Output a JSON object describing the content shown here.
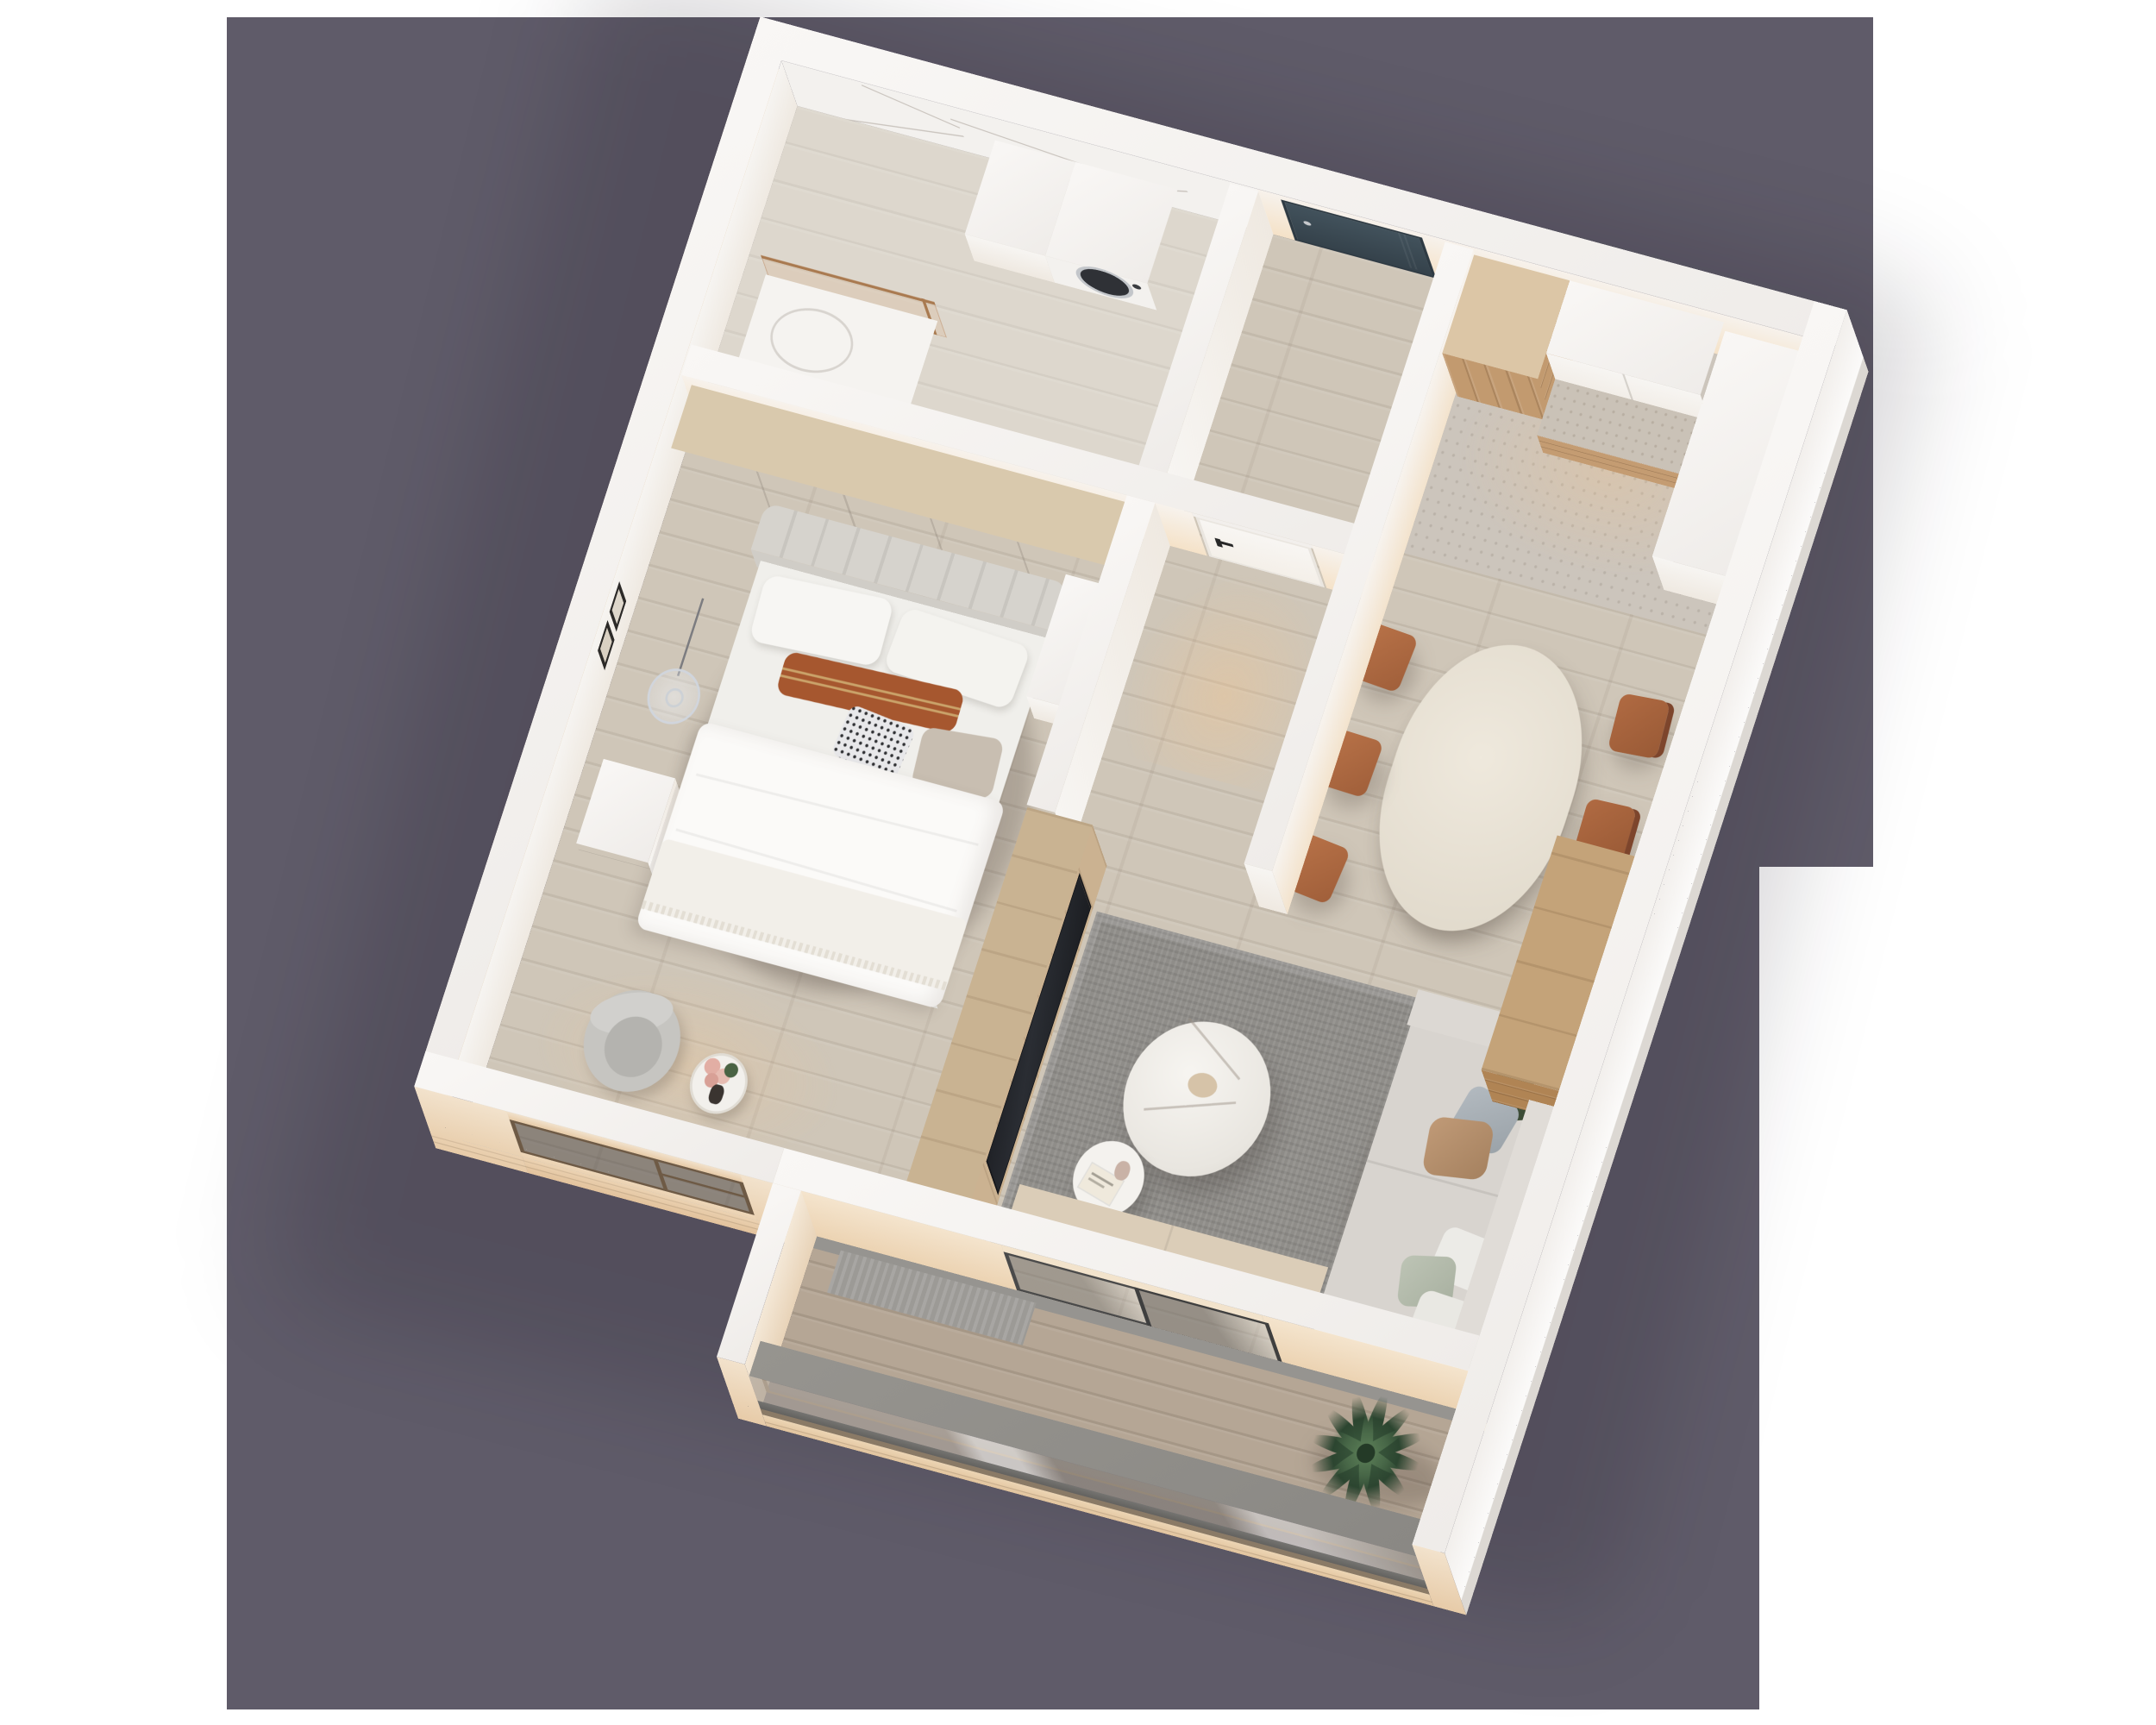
{
  "scene": {
    "type": "isometric-3d-floor-plan-render",
    "description": "Top-down cutaway 3D render of a one-bedroom apartment on a purple backdrop",
    "background_canvas": "#ffffff",
    "backdrop": "#5f5b69"
  },
  "palette": {
    "backdrop": "#5f5b69",
    "wallTop": "#f6f4f2",
    "warmGlow": "#f6ddbd",
    "exteriorCream": "#f0d9bd",
    "exteriorWhite": "#fafaf9",
    "marble": "#f3f1ee",
    "woodFloor": "#cdc4b6",
    "stoneFloor": "#ccc5bc",
    "balconyWood": "#b5a695",
    "rug": "#8f8d89",
    "sofa": "#d8d4cf",
    "chairRust": "#b06a42",
    "tableMarble": "#ebe5d9",
    "kitchenWood": "#c29a6f",
    "wardrobeWood": "#b08454",
    "entryDoorTeal": "#3f4e57",
    "tvScreen": "#202227",
    "palmGreen": "#2c4530",
    "pillowRust": "#a6572f",
    "stoneCap": "#908e8b",
    "bronze": "#a97a50"
  },
  "rooms": [
    {
      "name": "Bathroom",
      "furniture": [
        "washing machine",
        "storage cabinet",
        "sink vanity",
        "bronze glass shower screen",
        "marble feature wall"
      ]
    },
    {
      "name": "Entry Hall",
      "furniture": [
        "dark teal entry door"
      ]
    },
    {
      "name": "Hallway",
      "furniture": [
        "white interior door with black handle"
      ]
    },
    {
      "name": "Kitchen",
      "furniture": [
        "tall wood cabinet",
        "white upper cabinets",
        "stone countertop with wood drawers",
        "tall white cabinet"
      ]
    },
    {
      "name": "Dining Area",
      "furniture": [
        "oval stone dining table",
        "rust upholstered chairs",
        "wood wardrobe"
      ]
    },
    {
      "name": "Living Room",
      "furniture": [
        "gray area rug",
        "light gray sofa with pillows",
        "round marble coffee table",
        "round side table with book and vase",
        "TV on wood partition wall",
        "beige window bench",
        "sliding glass balcony door"
      ]
    },
    {
      "name": "Bedroom",
      "furniture": [
        "double bed with channel-tufted headboard",
        "white wardrobe with wood trim",
        "white nightstand",
        "glass pendant lamp",
        "two wall art frames",
        "boucle armchair",
        "round side table with flowers",
        "window to facade"
      ]
    },
    {
      "name": "Balcony",
      "furniture": [
        "potted palm plant",
        "striped outdoor mat",
        "glass railing with stone cap"
      ]
    }
  ],
  "counts": {
    "dining_chairs": 6,
    "sofa_pillows": 6,
    "bed_pillows": 5,
    "wall_frames": 2
  },
  "materials": {
    "floors": "light oak plank",
    "bathroom_wall": "white marble with gray veining",
    "kitchen_floor": "gray terrazzo stone",
    "balcony_railing": "reflective glass, bronze base, stone cap",
    "facade": "cream render with grooves"
  }
}
